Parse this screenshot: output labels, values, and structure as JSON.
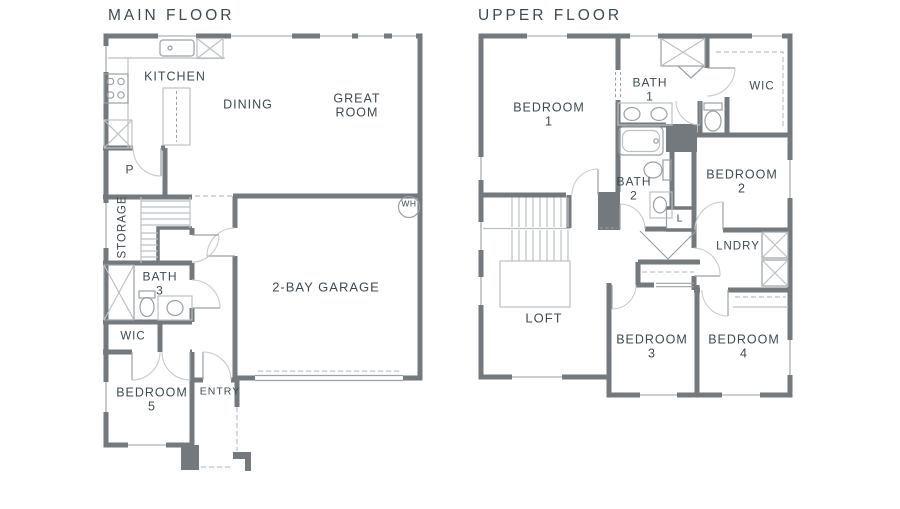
{
  "colors": {
    "wall": "#73797d",
    "lt": "#bcc1c3",
    "md": "#9aa0a3",
    "arc": "#c7cbcd",
    "text": "#3e4a4f"
  },
  "main_floor": {
    "title": "MAIN FLOOR",
    "kitchen": "KITCHEN",
    "dining": "DINING",
    "great_room": {
      "line1": "GREAT",
      "line2": "ROOM"
    },
    "pantry": "P",
    "storage": "STORAGE",
    "bath3": {
      "line1": "BATH",
      "line2": "3"
    },
    "wic": "WIC",
    "bedroom5": {
      "line1": "BEDROOM",
      "line2": "5"
    },
    "entry": "ENTRY",
    "garage": "2-BAY GARAGE",
    "water_heater": "WH"
  },
  "upper_floor": {
    "title": "UPPER FLOOR",
    "bedroom1": {
      "line1": "BEDROOM",
      "line2": "1"
    },
    "bath1": {
      "line1": "BATH",
      "line2": "1"
    },
    "wic": "WIC",
    "bath2": {
      "line1": "BATH",
      "line2": "2"
    },
    "linen": "L",
    "bedroom2": {
      "line1": "BEDROOM",
      "line2": "2"
    },
    "laundry": "LNDRY",
    "loft": "LOFT",
    "bedroom3": {
      "line1": "BEDROOM",
      "line2": "3"
    },
    "bedroom4": {
      "line1": "BEDROOM",
      "line2": "4"
    }
  }
}
